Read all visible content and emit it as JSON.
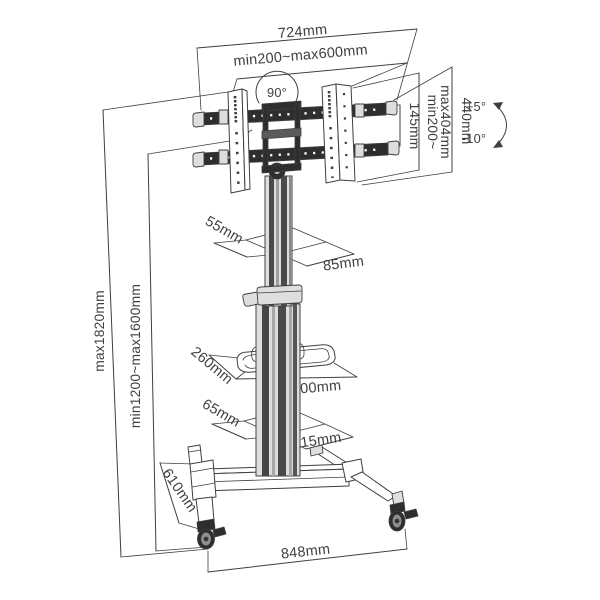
{
  "theme": {
    "line": "#3f3f3f",
    "dark": "#2e2e2e",
    "mid": "#8f8f8f",
    "light": "#dedede",
    "paper": "#ffffff"
  },
  "diagram": {
    "type": "technical-dimension-drawing",
    "subject": "mobile TV floor stand with casters, shelf and tilting VESA bracket"
  },
  "labels": {
    "overall_width": "724mm",
    "vesa_width_range": "min200~max600mm",
    "rotation_angle": "90°",
    "bracket_gap_height": "145mm",
    "vesa_height_range_line1": "min200~",
    "vesa_height_range_line2": "max404mm",
    "bracket_height": "440mm",
    "tilt_up": "+5°",
    "tilt_down": "-10°",
    "overall_height_max": "max1820mm",
    "screen_height_range": "min1200~max1600mm",
    "upper_column_depth": "55mm",
    "upper_column_width": "85mm",
    "shelf_depth": "260mm",
    "shelf_width": "400mm",
    "lower_column_depth": "65mm",
    "lower_column_width": "115mm",
    "base_depth": "610mm",
    "base_width": "848mm"
  }
}
